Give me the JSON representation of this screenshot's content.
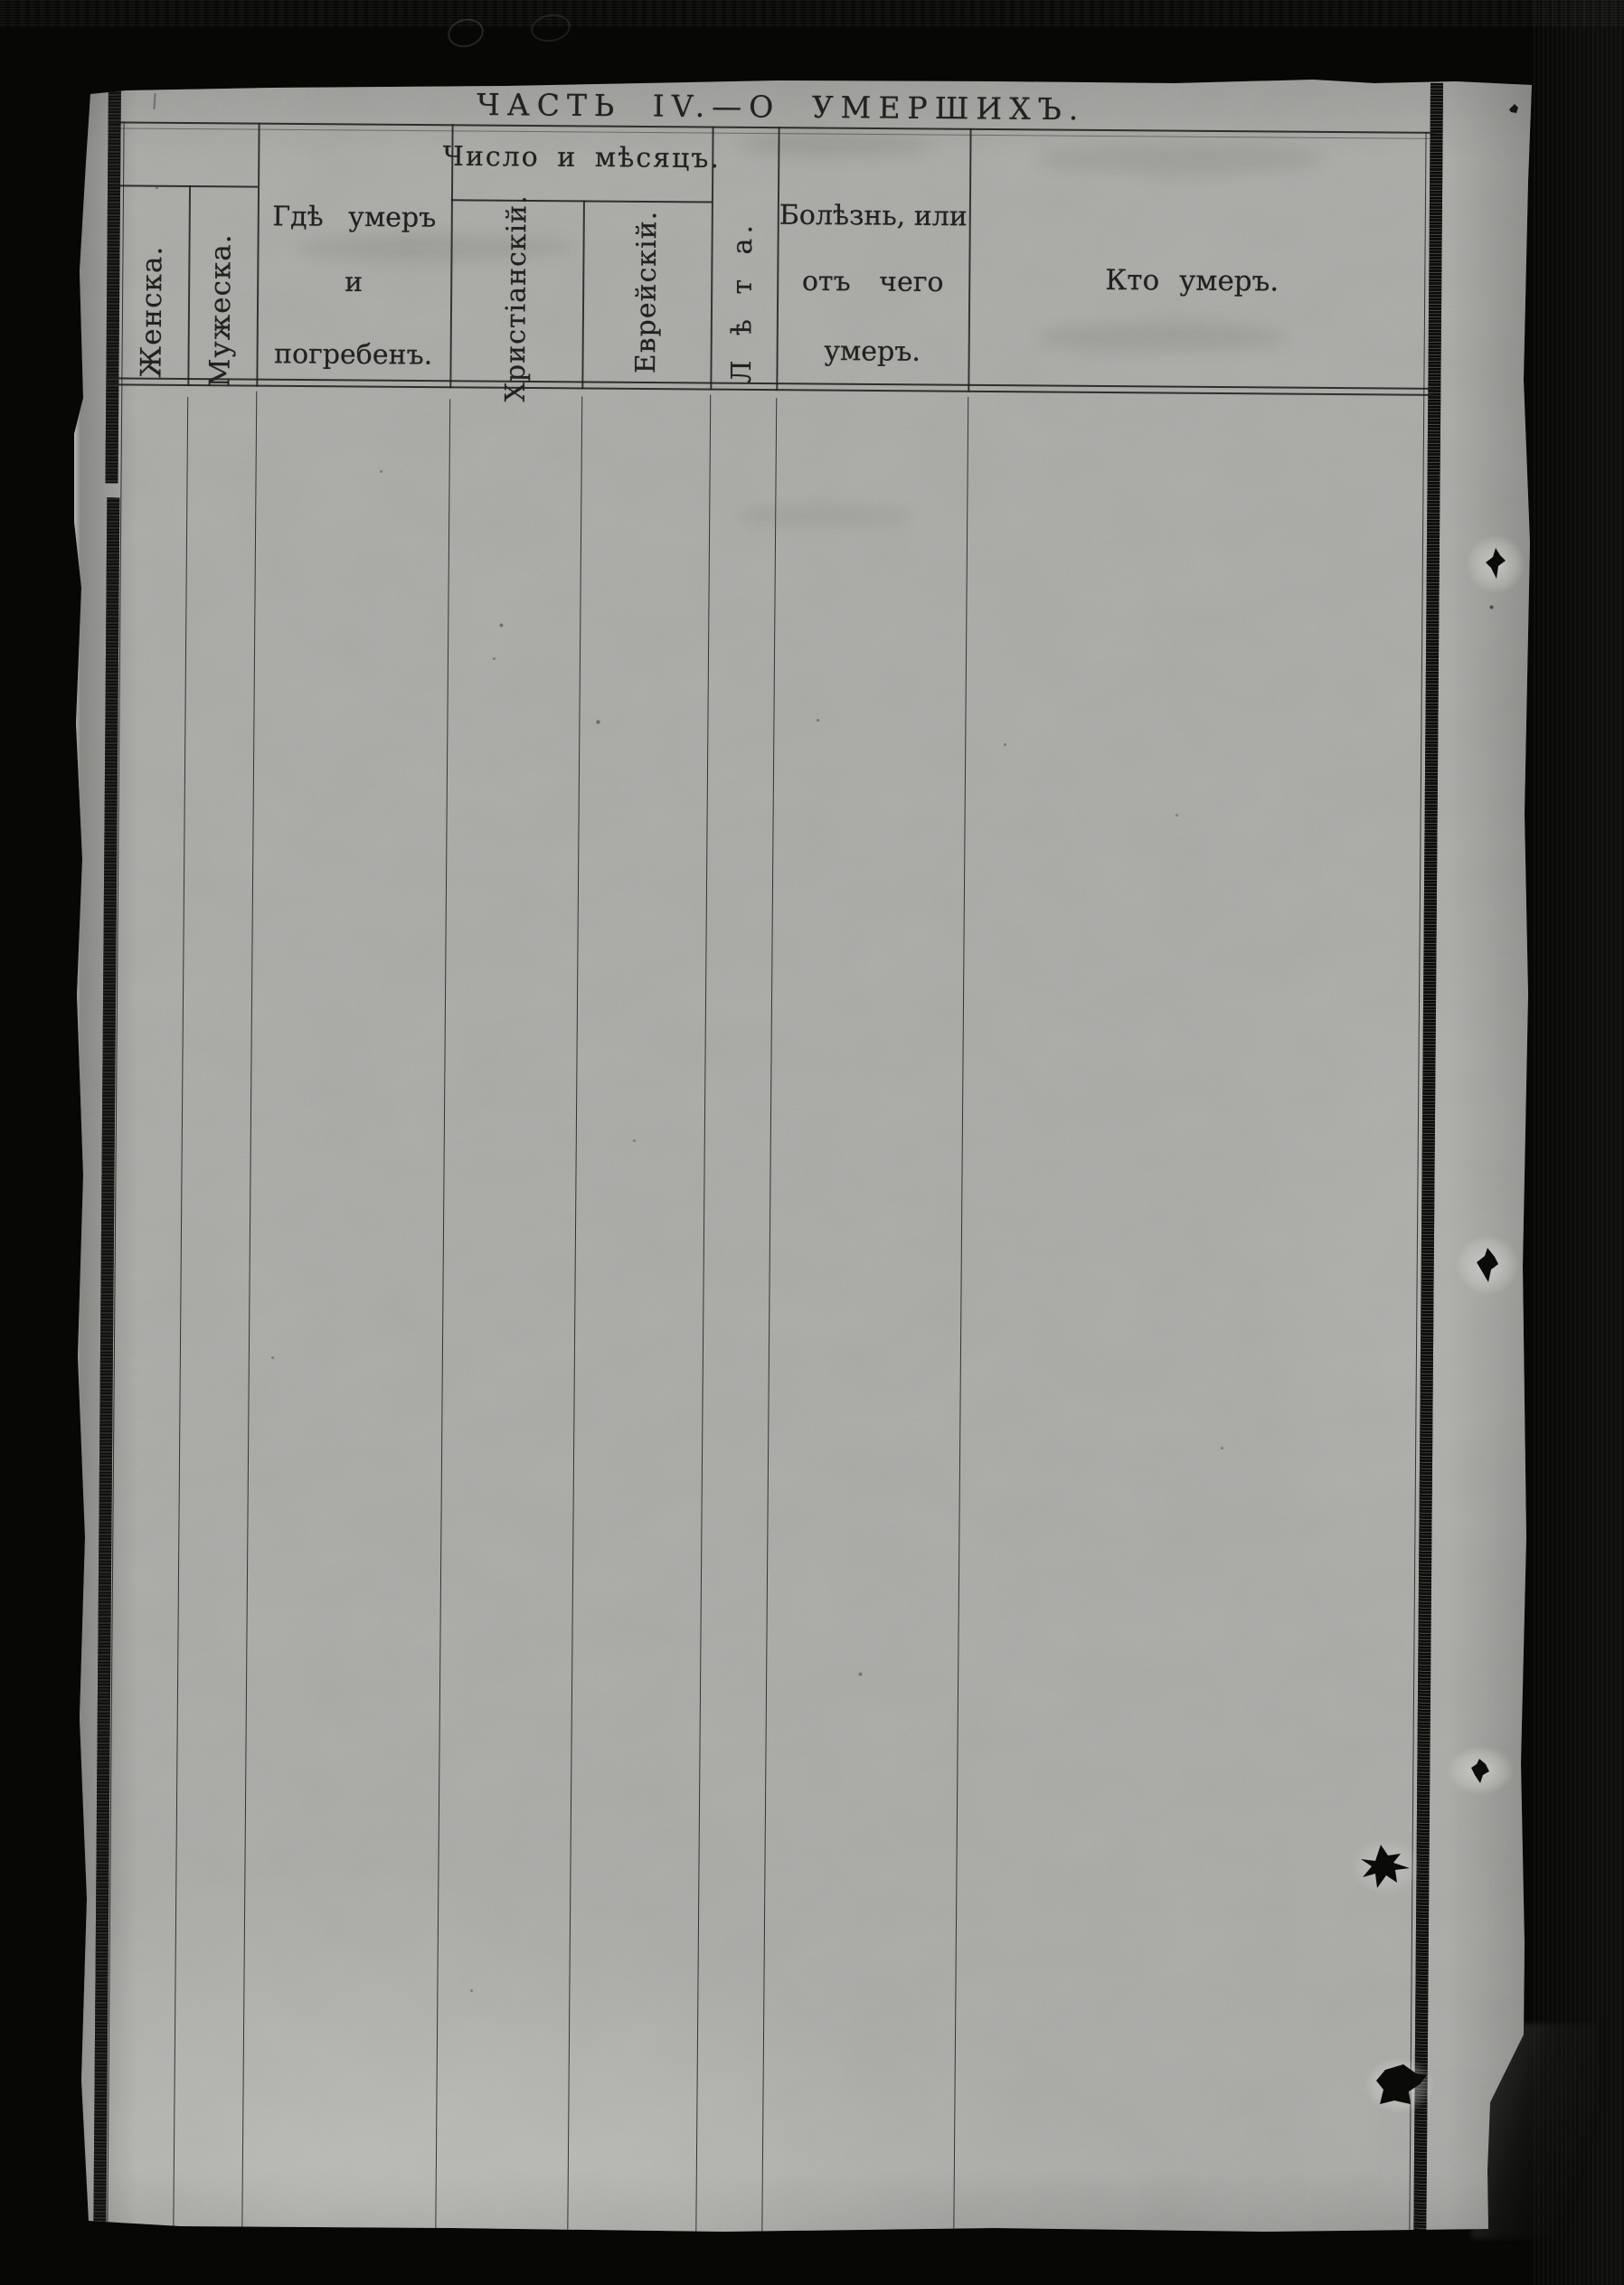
{
  "title": "ЧАСТЬ IV.—О УМЕРШИХЪ.",
  "table": {
    "columns": [
      {
        "key": "female",
        "label": "Женска.",
        "orientation": "vertical"
      },
      {
        "key": "male",
        "label": "Мужеска.",
        "orientation": "vertical"
      },
      {
        "key": "where_died_and_buried",
        "label": "Гдѣ умеръ и погребенъ.",
        "lines": [
          "Гдѣ умеръ",
          "и",
          "погребенъ."
        ]
      },
      {
        "key": "date_and_month",
        "label": "Число и мѣсяцъ.",
        "subcolumns": [
          {
            "key": "christian_calendar",
            "label": "Христіанскій.",
            "orientation": "vertical"
          },
          {
            "key": "jewish_calendar",
            "label": "Еврейскій.",
            "orientation": "vertical"
          }
        ]
      },
      {
        "key": "age",
        "label": "Л ѣ т а.",
        "orientation": "vertical"
      },
      {
        "key": "illness_or_cause_of_death",
        "label": "Болѣзнь, или отъ чего умеръ.",
        "lines": [
          "Болѣзнь, или",
          "отъ чего",
          "умеръ."
        ]
      },
      {
        "key": "who_died",
        "label": "Кто умеръ."
      }
    ],
    "rows": []
  },
  "colors": {
    "paper": "#b1b1ae",
    "ink": "#1f1f1d",
    "background": "#060605"
  }
}
